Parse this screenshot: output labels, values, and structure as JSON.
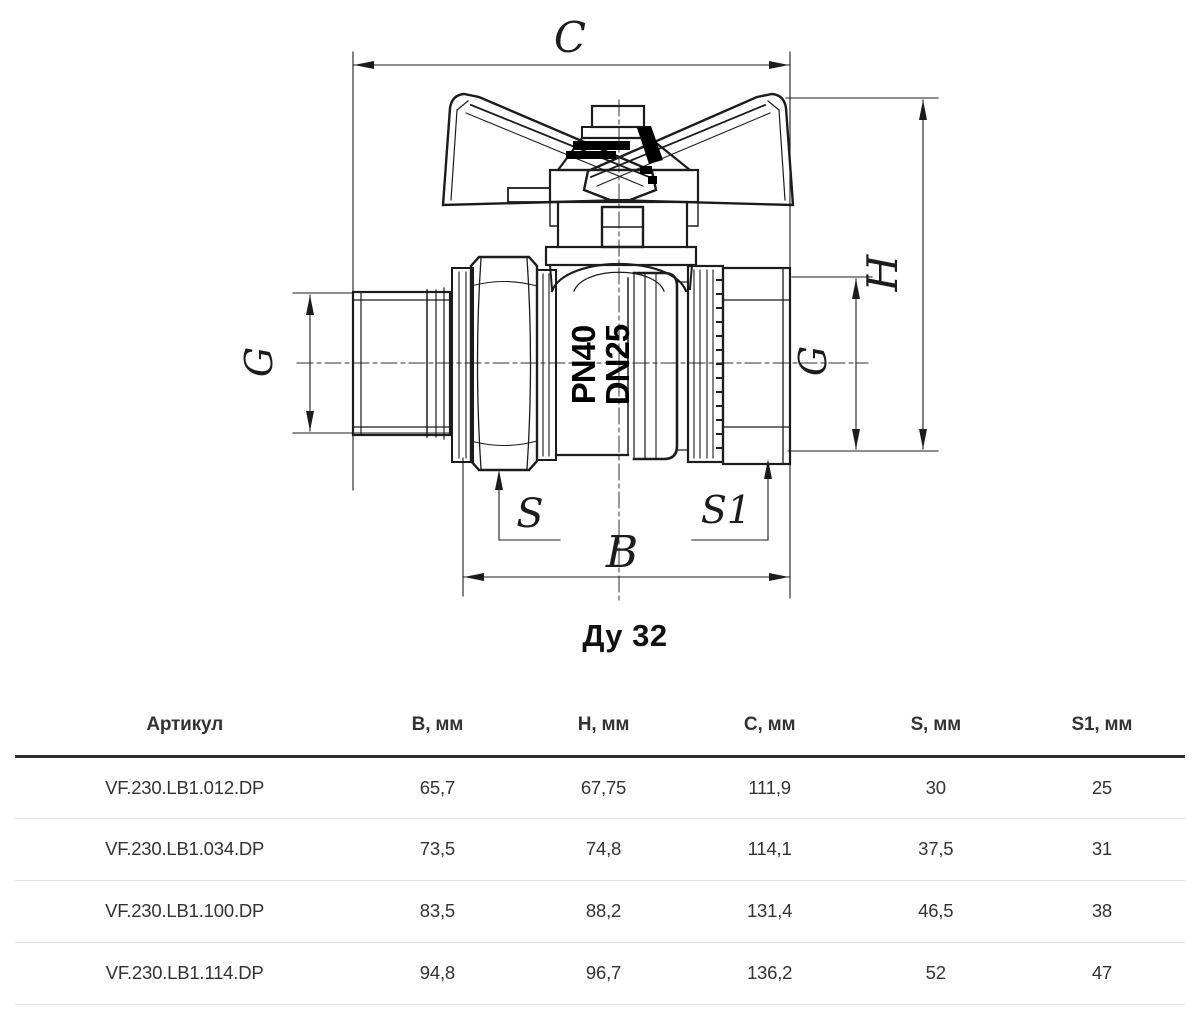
{
  "drawing": {
    "caption": "Ду 32",
    "marking": {
      "line1": "PN40",
      "line2": "DN25"
    },
    "dims": {
      "c": "C",
      "h": "H",
      "g_left": "G",
      "g_right": "G",
      "s": "S",
      "s1": "S1",
      "b": "B"
    }
  },
  "table": {
    "headers": [
      "Артикул",
      "B, мм",
      "H, мм",
      "C, мм",
      "S, мм",
      "S1, мм"
    ],
    "rows": [
      [
        "VF.230.LB1.012.DP",
        "65,7",
        "67,75",
        "111,9",
        "30",
        "25"
      ],
      [
        "VF.230.LB1.034.DP",
        "73,5",
        "74,8",
        "114,1",
        "37,5",
        "31"
      ],
      [
        "VF.230.LB1.100.DP",
        "83,5",
        "88,2",
        "131,4",
        "46,5",
        "38"
      ],
      [
        "VF.230.LB1.114.DP",
        "94,8",
        "96,7",
        "136,2",
        "52",
        "47"
      ]
    ]
  },
  "colors": {
    "line": "#1c1c1c",
    "table_text": "#333333",
    "header_rule": "#2b2b2b",
    "row_separator": "#e0e0e0"
  }
}
